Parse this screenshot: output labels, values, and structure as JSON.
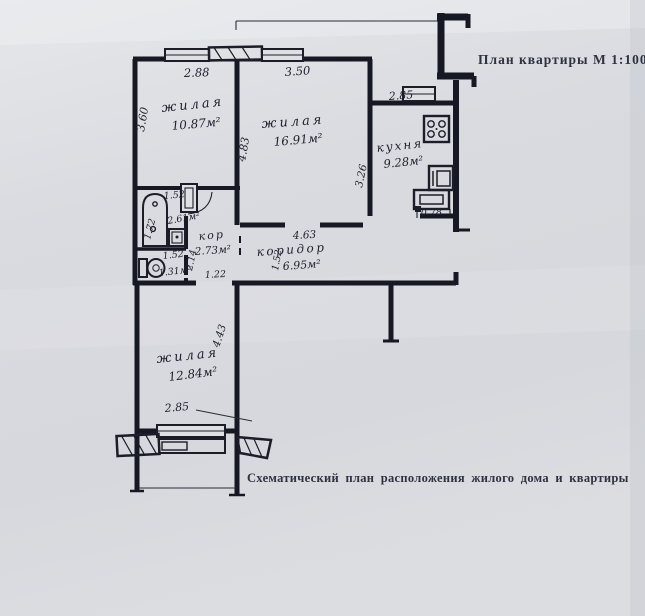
{
  "page": {
    "title": "План квартиры М 1:100",
    "caption": "Схематический план расположения жилого дома и квартиры"
  },
  "plan": {
    "room_living_1": {
      "label": "жилая",
      "area": "10.87м²",
      "dim_width": "2.88",
      "dim_height": "3.60"
    },
    "room_living_2": {
      "label": "жилая",
      "area": "16.91м²",
      "dim_width": "3.50",
      "dim_height": "4.83"
    },
    "kitchen": {
      "label": "кухня",
      "area": "9.28м²",
      "dim_width": "2.85",
      "dim_height": "3.26",
      "dim_entry": "0.78"
    },
    "bathroom": {
      "area": "2.61м²",
      "dim_width": "1.52",
      "dim_height": "1.72"
    },
    "wc": {
      "area": "1.31м²",
      "dim_width": "1.52"
    },
    "hall": {
      "label": "кор",
      "area": "2.73м²",
      "dim_door": "1.22",
      "dim_height": "2.14"
    },
    "corridor": {
      "label": "коридор",
      "area": "6.95м²",
      "dim_length": "4.63",
      "dim_width": "1.52"
    },
    "room_living_3": {
      "label": "жилая",
      "area": "12.84м²",
      "dim_width": "2.85",
      "dim_height": "4.43"
    }
  }
}
